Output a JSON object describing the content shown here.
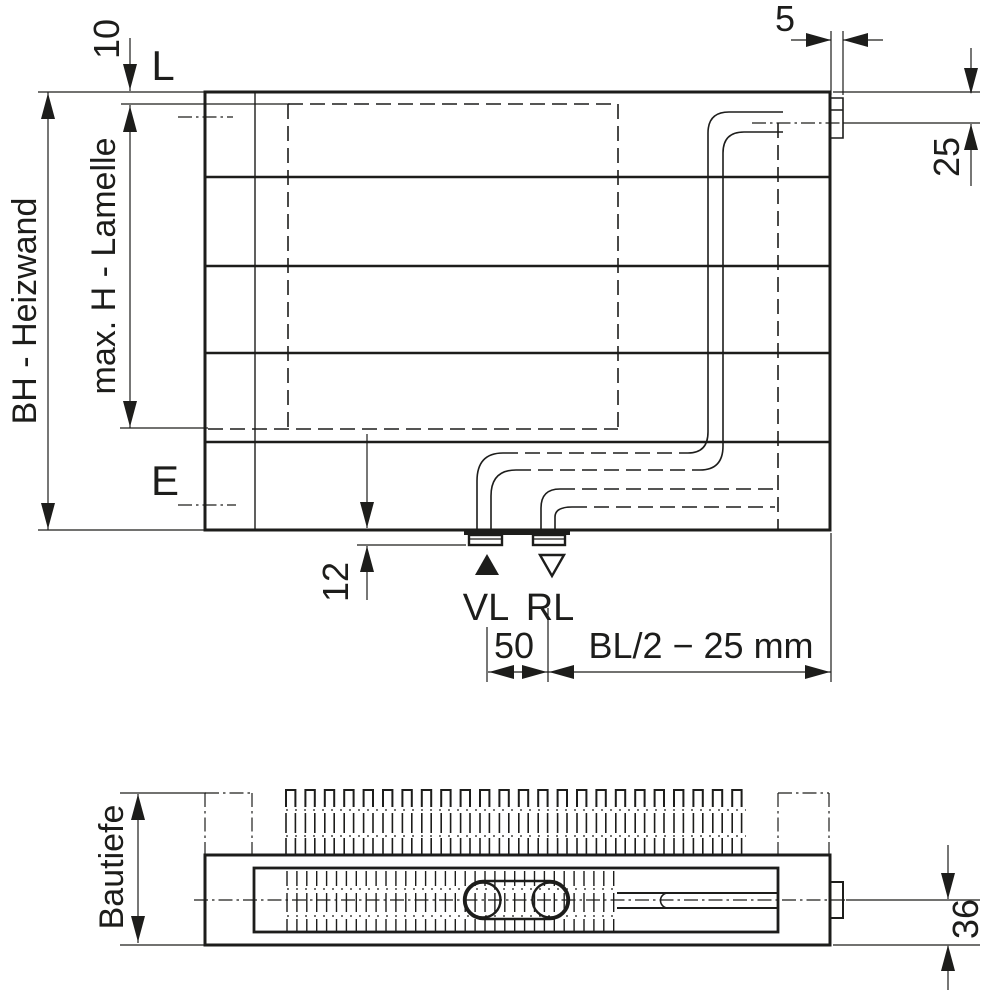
{
  "title": "Heizwand Massskizze",
  "colors": {
    "line": "#1d1d1b",
    "background": "#ffffff"
  },
  "front_view": {
    "labels": {
      "height_total": "BH - Heizwand",
      "height_fins": "max. H - Lamelle",
      "vent_mark": "L",
      "drain_mark": "E",
      "supply": "VL",
      "return": "RL"
    },
    "dims": {
      "top_edge_to_fins": "10",
      "vent_nipple_width": "5",
      "top_to_vent_center": "25",
      "bottom_to_connection": "12",
      "connection_spacing": "50",
      "connection_to_right_edge": "BL/2 − 25 mm"
    }
  },
  "top_view": {
    "labels": {
      "depth": "Bautiefe"
    },
    "dims": {
      "center_to_bottom": "36"
    }
  }
}
